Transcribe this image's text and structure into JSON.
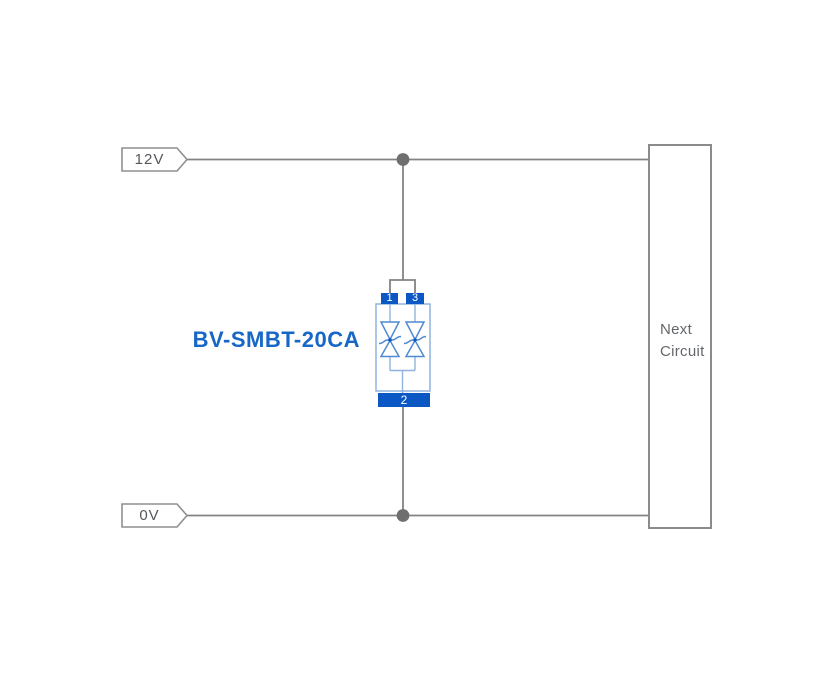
{
  "diagram": {
    "nets": {
      "top": "12V",
      "bottom": "0V"
    },
    "component": {
      "name": "BV-SMBT-20CA",
      "symbol": "bidirectional-tvs-diode-pair",
      "pins": {
        "pin1": "1",
        "pin2": "2",
        "pin3": "3"
      }
    },
    "next_circuit": {
      "label": "Next Circuit"
    },
    "colors": {
      "wire": "#838383",
      "junction": "#6f6f6f",
      "flag-border": "#8f8f8f",
      "flag-text": "#54585c",
      "box-border": "#8b8b8b",
      "box-text": "#63676b",
      "pad-blue": "#0b57c4",
      "pad-text": "#ffffff",
      "body-blue": "#8fb3de",
      "diode-blue": "#4f8ad2",
      "label-blue": "#1667c6"
    }
  }
}
